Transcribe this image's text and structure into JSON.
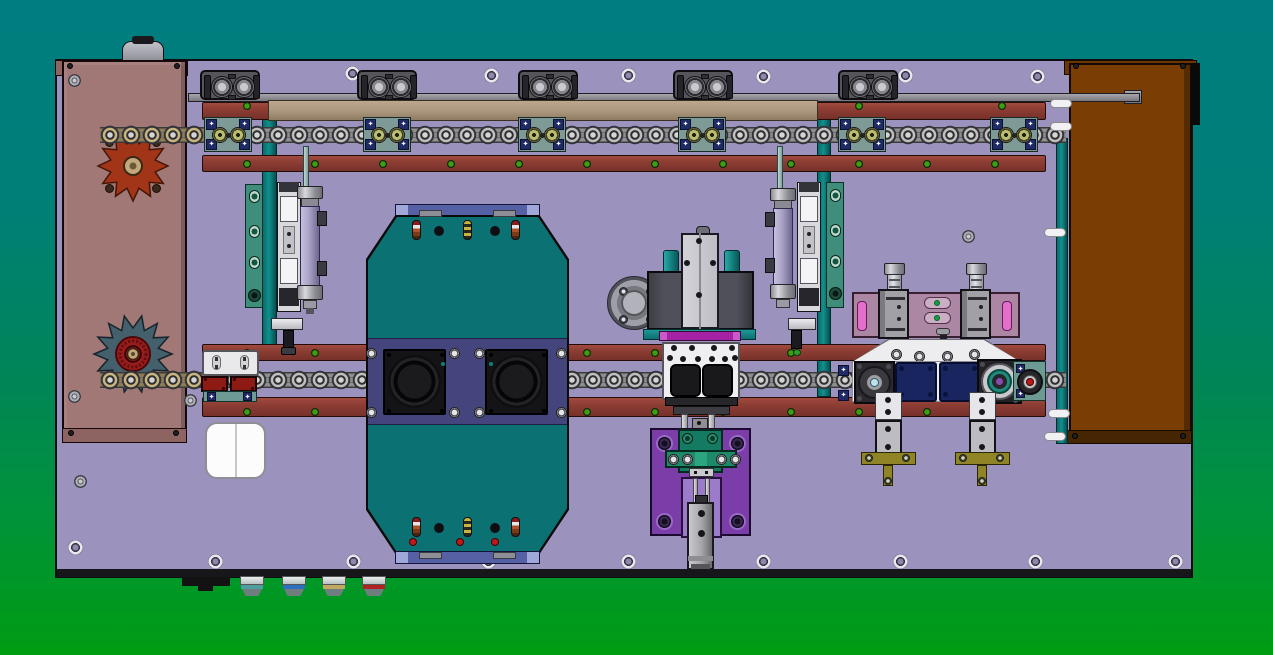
{
  "scene": {
    "type": "cad-top-view",
    "description": "Top view CAD rendering of a chain-driven conveyor and assembly machine on a teal-to-green gradient backdrop",
    "background": {
      "top": "#007D80",
      "middle": "#008557",
      "bottom": "#009C12"
    }
  },
  "palette": {
    "bg-top": "#007D80",
    "bg-mid": "#008557",
    "bg-bottom": "#009C12",
    "plate": "#9B92BD",
    "rail": "#8E3E34",
    "tan-bar": "#AD9880",
    "gray-bar": "#8A8A90",
    "teal-bar": "#0C7F7F",
    "panel-left": "#A17876",
    "panel-left-trim": "#8E6462",
    "panel-right": "#7A3E04",
    "panel-right-trim": "#6B3504",
    "octagon": "#0B7173",
    "octagon-band": "#45457E",
    "blue-bar": "#5560A5",
    "blue-bar-end": "#9FA8D8",
    "cyl-block": "#55555B",
    "guide-block": "#7E9A96",
    "navy": "#1F2A66",
    "navy-pad": "#18255E",
    "purple-plate": "#7B3EA8",
    "purple-light": "#9C7CCA",
    "green-block": "#157A62",
    "green-bar": "#1F8A6A",
    "magenta": "#A522A5",
    "pink-plate": "#AB87A4",
    "pink-slot": "#E36FCB",
    "red": "#C01818",
    "olive": "#8F8526",
    "green-screw": "#3F9D14",
    "lav-cyl": "#A9A2C6",
    "teal-plate": "#3F8E7C",
    "teal-base": "#6E9A94"
  },
  "components": {
    "top_cylinder_blocks": {
      "count": 5,
      "y": 70,
      "xs": [
        200,
        357,
        518,
        673,
        838
      ]
    },
    "chain_guide_blocks": {
      "count": 6,
      "y": 117,
      "xs": [
        204,
        363,
        518,
        678,
        838,
        990
      ]
    },
    "chains": [
      {
        "x": 100,
        "y": 124,
        "w": 966,
        "variant": "gray"
      },
      {
        "x": 100,
        "y": 369,
        "w": 966,
        "variant": "gray"
      },
      {
        "x": 100,
        "y": 124,
        "w": 112,
        "variant": "olive"
      },
      {
        "x": 100,
        "y": 369,
        "w": 112,
        "variant": "olive"
      }
    ],
    "sprockets": [
      {
        "cx": 133,
        "cy": 166,
        "teeth": 12,
        "router": 35,
        "rinner": 23,
        "fill": "#A23418",
        "stroke": "#431606",
        "hub": "tan"
      },
      {
        "cx": 133,
        "cy": 354,
        "teeth": 14,
        "router": 39,
        "rinner": 26,
        "fill": "#44606C",
        "stroke": "#16242C",
        "hub": "red-knurl"
      }
    ],
    "rail_green_screws": [
      [
        247,
        106
      ],
      [
        859,
        106
      ],
      [
        1002,
        106
      ],
      [
        247,
        164
      ],
      [
        315,
        164
      ],
      [
        383,
        164
      ],
      [
        451,
        164
      ],
      [
        519,
        164
      ],
      [
        587,
        164
      ],
      [
        655,
        164
      ],
      [
        723,
        164
      ],
      [
        791,
        164
      ],
      [
        859,
        164
      ],
      [
        927,
        164
      ],
      [
        995,
        164
      ],
      [
        247,
        353
      ],
      [
        315,
        353
      ],
      [
        587,
        353
      ],
      [
        655,
        353
      ],
      [
        791,
        353
      ],
      [
        247,
        412
      ],
      [
        315,
        412
      ],
      [
        587,
        412
      ],
      [
        655,
        412
      ],
      [
        723,
        412
      ],
      [
        791,
        412
      ],
      [
        859,
        412
      ],
      [
        927,
        412
      ]
    ],
    "plate_holes": [
      [
        352,
        73
      ],
      [
        491,
        75
      ],
      [
        628,
        75
      ],
      [
        763,
        76
      ],
      [
        905,
        75
      ],
      [
        1037,
        76
      ],
      [
        75,
        547
      ],
      [
        215,
        561
      ],
      [
        353,
        561
      ],
      [
        488,
        561
      ],
      [
        628,
        561
      ],
      [
        763,
        561
      ],
      [
        900,
        561
      ],
      [
        1035,
        561
      ],
      [
        1175,
        561
      ]
    ],
    "hex_screws": [
      [
        74,
        80
      ],
      [
        74,
        396
      ],
      [
        190,
        400
      ],
      [
        80,
        481
      ],
      [
        968,
        236
      ]
    ],
    "trim_screws": [
      [
        70,
        66
      ],
      [
        177,
        66
      ],
      [
        71,
        433
      ],
      [
        176,
        433
      ],
      [
        1076,
        66
      ],
      [
        1183,
        66
      ],
      [
        1075,
        436
      ],
      [
        1183,
        436
      ]
    ],
    "octagon_pins": {
      "xs": [
        412,
        463,
        511
      ],
      "top_y": 220,
      "bottom_y": 517,
      "variants": [
        "red",
        "yellow",
        "red"
      ]
    },
    "octagon_dots": [
      [
        434,
        226
      ],
      [
        490,
        226
      ],
      [
        434,
        523
      ],
      [
        490,
        523
      ]
    ],
    "octagon_red_dots": [
      [
        409,
        538
      ],
      [
        456,
        538
      ],
      [
        491,
        538
      ]
    ],
    "band_screws": [
      [
        371,
        353
      ],
      [
        454,
        353
      ],
      [
        479,
        353
      ],
      [
        561,
        353
      ],
      [
        371,
        412
      ],
      [
        454,
        412
      ],
      [
        479,
        412
      ],
      [
        561,
        412
      ]
    ],
    "white_pills": [
      [
        1050,
        99
      ],
      [
        1050,
        122
      ],
      [
        1044,
        228
      ],
      [
        1048,
        409
      ],
      [
        1044,
        432
      ]
    ],
    "feet": {
      "xs": [
        240,
        282,
        322,
        362
      ],
      "stripes": [
        "#4F9EA0",
        "#2C6FBF",
        "#C0A860",
        "#B22222"
      ]
    }
  }
}
